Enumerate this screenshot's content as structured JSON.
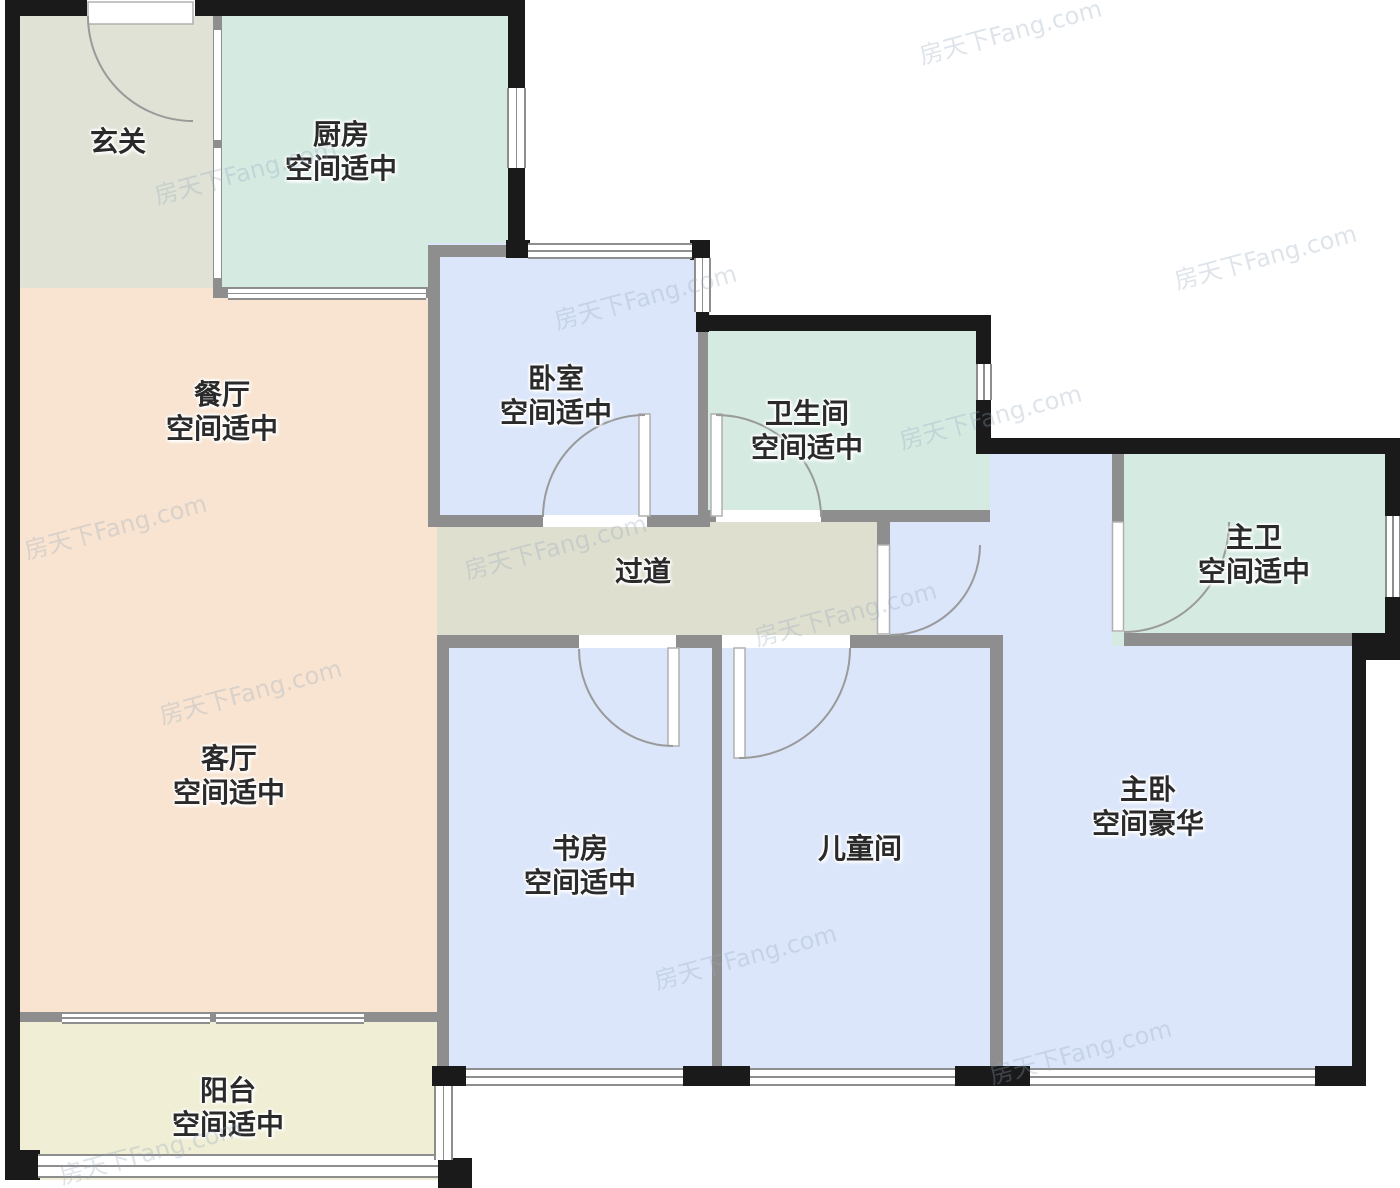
{
  "floorplan": {
    "watermark": "房天下Fang.com",
    "rooms": {
      "entry_hall": {
        "name": "玄关",
        "assessment": ""
      },
      "kitchen": {
        "name": "厨房",
        "assessment": "空间适中"
      },
      "dining_room": {
        "name": "餐厅",
        "assessment": "空间适中"
      },
      "bedroom": {
        "name": "卧室",
        "assessment": "空间适中"
      },
      "bathroom": {
        "name": "卫生间",
        "assessment": "空间适中"
      },
      "master_bathroom": {
        "name": "主卫",
        "assessment": "空间适中"
      },
      "corridor": {
        "name": "过道",
        "assessment": ""
      },
      "living_room": {
        "name": "客厅",
        "assessment": "空间适中"
      },
      "study": {
        "name": "书房",
        "assessment": "空间适中"
      },
      "children_room": {
        "name": "儿童间",
        "assessment": ""
      },
      "master_bedroom": {
        "name": "主卧",
        "assessment": "空间豪华"
      },
      "balcony": {
        "name": "阳台",
        "assessment": "空间适中"
      }
    },
    "colors": {
      "wall_black": "#1a1a1a",
      "wall_gray": "#8e8e8e",
      "mint": "#d5ebe2",
      "peach": "#f8e4d0",
      "blue": "#dbe6fa",
      "olive": "#dfdfcf",
      "sage": "#dfe2d4",
      "cream": "#f0eed4",
      "label_text": "#2a2a2a",
      "watermark_text": "#93a7bd"
    }
  }
}
